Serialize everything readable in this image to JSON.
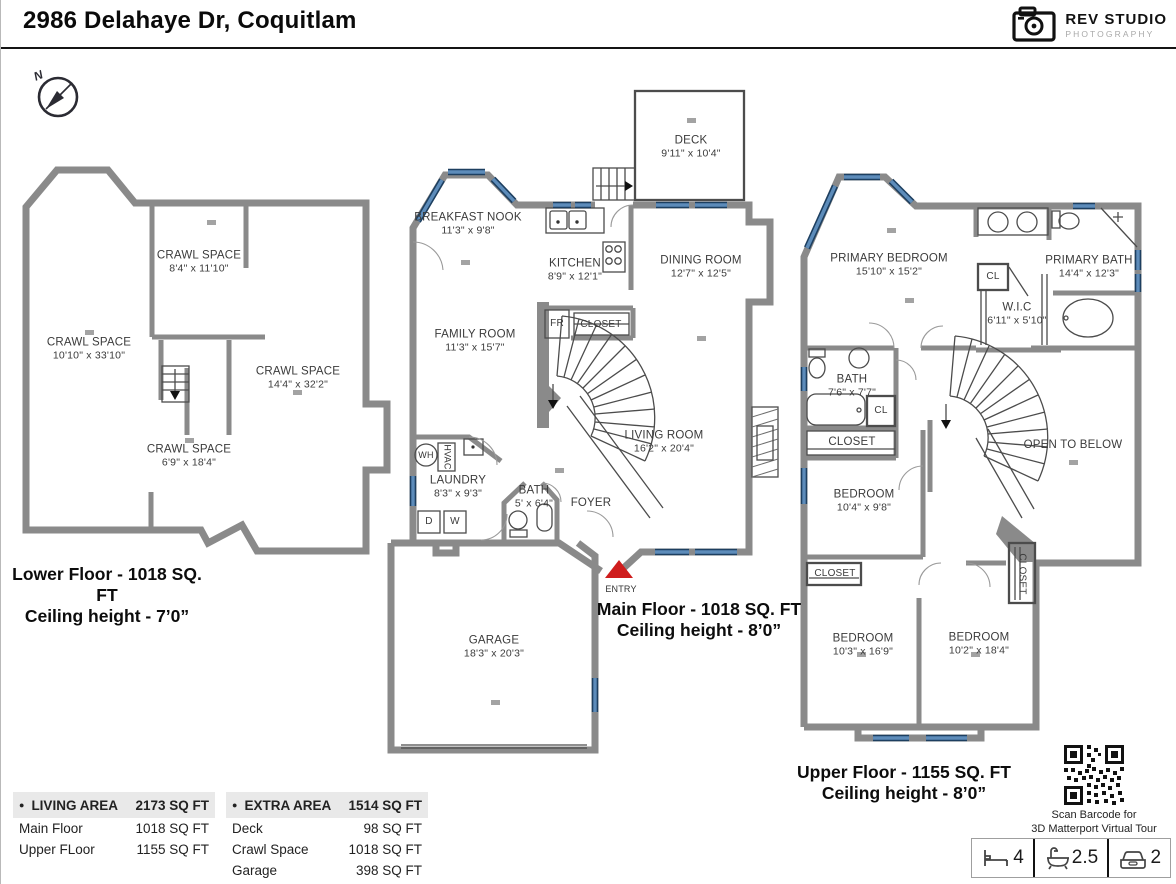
{
  "header": {
    "title": "2986 Delahaye Dr, Coquitlam"
  },
  "logo": {
    "brand": "REV STUDIO",
    "sub": "PHOTOGRAPHY"
  },
  "compass": {
    "n": "N"
  },
  "floors": {
    "lower": {
      "caption1": "Lower Floor - 1018 SQ. FT",
      "caption2": "Ceiling height - 7’0”",
      "rooms": {
        "cs1": {
          "name": "CRAWL SPACE",
          "dims": "8'4\" x 11'10\""
        },
        "cs2": {
          "name": "CRAWL SPACE",
          "dims": "10'10\" x 33'10\""
        },
        "cs3": {
          "name": "CRAWL SPACE",
          "dims": "14'4\" x 32'2\""
        },
        "cs4": {
          "name": "CRAWL SPACE",
          "dims": "6'9\" x 18'4\""
        }
      }
    },
    "main": {
      "caption1": "Main Floor - 1018 SQ. FT",
      "caption2": "Ceiling height - 8’0”",
      "rooms": {
        "deck": {
          "name": "DECK",
          "dims": "9'11\" x 10'4\""
        },
        "nook": {
          "name": "BREAKFAST NOOK",
          "dims": "11'3\" x 9'8\""
        },
        "kitchen": {
          "name": "KITCHEN",
          "dims": "8'9\" x 12'1\""
        },
        "dining": {
          "name": "DINING ROOM",
          "dims": "12'7\" x 12'5\""
        },
        "family": {
          "name": "FAMILY ROOM",
          "dims": "11'3\" x 15'7\""
        },
        "living": {
          "name": "LIVING ROOM",
          "dims": "16'2\" x 20'4\""
        },
        "laundry": {
          "name": "LAUNDRY",
          "dims": "8'3\" x 9'3\""
        },
        "bath": {
          "name": "BATH",
          "dims": "5' x 6'4\""
        },
        "foyer": {
          "name": "FOYER"
        },
        "garage": {
          "name": "GARAGE",
          "dims": "18'3\" x 20'3\""
        },
        "closet": {
          "name": "CLOSET"
        },
        "fr": {
          "name": "FR"
        },
        "wh": {
          "name": "WH"
        },
        "hvac": {
          "name": "HVAC"
        },
        "dryer": {
          "name": "D"
        },
        "washer": {
          "name": "W"
        },
        "entry": {
          "name": "ENTRY"
        }
      }
    },
    "upper": {
      "caption1": "Upper Floor - 1155 SQ. FT",
      "caption2": "Ceiling height - 8’0”",
      "rooms": {
        "primary": {
          "name": "PRIMARY BEDROOM",
          "dims": "15'10\" x 15'2\""
        },
        "pbath": {
          "name": "PRIMARY BATH",
          "dims": "14'4\" x 12'3\""
        },
        "wic": {
          "name": "W.I.C",
          "dims": "6'11\" x 5'10\""
        },
        "bath": {
          "name": "BATH",
          "dims": "7'6\" x 7'7\""
        },
        "bed1": {
          "name": "BEDROOM",
          "dims": "10'4\" x 9'8\""
        },
        "bed2": {
          "name": "BEDROOM",
          "dims": "10'3\" x 16'9\""
        },
        "bed3": {
          "name": "BEDROOM",
          "dims": "10'2\" x 18'4\""
        },
        "open": {
          "name": "OPEN TO BELOW"
        },
        "cl1": {
          "name": "CL"
        },
        "cl2": {
          "name": "CL"
        },
        "closet1": {
          "name": "CLOSET"
        },
        "closet2": {
          "name": "CLOSET"
        },
        "closet3": {
          "name": "CLOSET"
        }
      }
    }
  },
  "tables": {
    "bullet": "●",
    "living": {
      "header": "LIVING AREA",
      "total": "2173 SQ FT",
      "rows": [
        {
          "label": "Main Floor",
          "value": "1018 SQ FT"
        },
        {
          "label": "Upper FLoor",
          "value": "1155 SQ FT"
        }
      ]
    },
    "extra": {
      "header": "EXTRA AREA",
      "total": "1514 SQ FT",
      "rows": [
        {
          "label": "Deck",
          "value": "98 SQ FT"
        },
        {
          "label": "Crawl Space",
          "value": "1018 SQ FT"
        },
        {
          "label": "Garage",
          "value": "398 SQ FT"
        }
      ]
    }
  },
  "qr": {
    "line1": "Scan Barcode for",
    "line2": "3D Matterport Virtual Tour"
  },
  "stats": {
    "beds": "4",
    "baths": "2.5",
    "garage": "2"
  },
  "colors": {
    "wall": "#8a8a8a",
    "window": "#5d8cba",
    "entry": "#cf1d1d"
  }
}
